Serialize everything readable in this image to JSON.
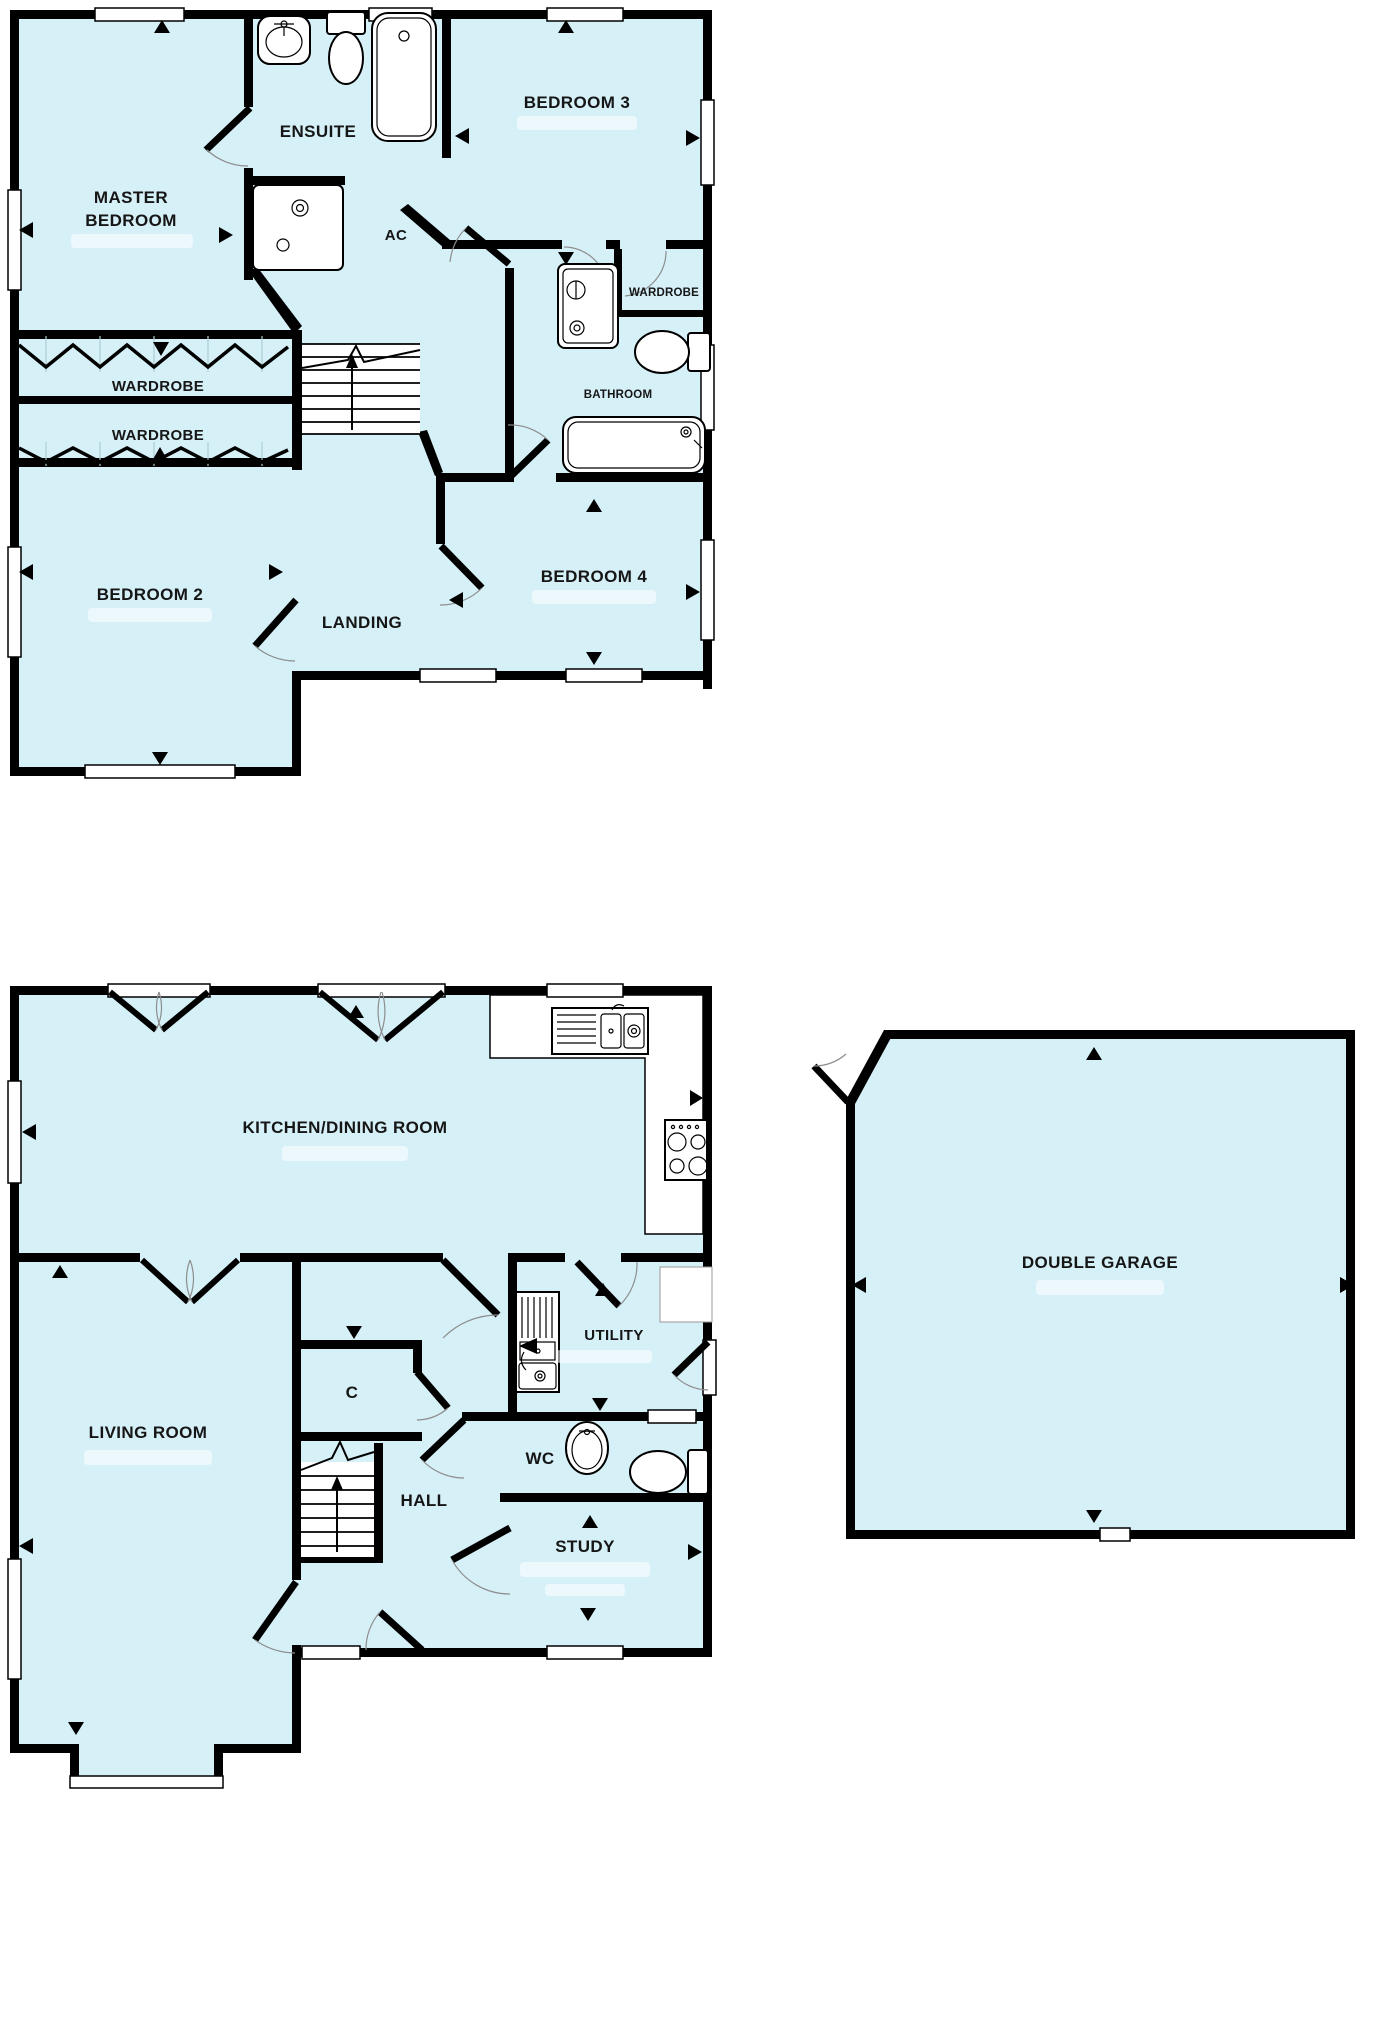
{
  "plan": {
    "colors": {
      "room_fill": "#d6f0f8",
      "wall": "#000000",
      "fixture_fill": "#ffffff",
      "label_color": "#161616"
    },
    "first_floor": {
      "rooms": {
        "master_bedroom": {
          "label_line1": "MASTER",
          "label_line2": "BEDROOM"
        },
        "ensuite": {
          "label": "ENSUITE"
        },
        "ac": {
          "label": "AC"
        },
        "bedroom3": {
          "label": "BEDROOM 3"
        },
        "wardrobe_top": {
          "label": "WARDROBE"
        },
        "wardrobe_bottom": {
          "label": "WARDROBE"
        },
        "wardrobe_small": {
          "label": "WARDROBE"
        },
        "bathroom": {
          "label": "BATHROOM"
        },
        "bedroom2": {
          "label": "BEDROOM 2"
        },
        "landing": {
          "label": "LANDING"
        },
        "bedroom4": {
          "label": "BEDROOM 4"
        }
      }
    },
    "ground_floor": {
      "rooms": {
        "kitchen_dining": {
          "label": "KITCHEN/DINING ROOM"
        },
        "living_room": {
          "label": "LIVING ROOM"
        },
        "cupboard": {
          "label": "C"
        },
        "utility": {
          "label": "UTILITY"
        },
        "wc": {
          "label": "WC"
        },
        "hall": {
          "label": "HALL"
        },
        "study": {
          "label": "STUDY"
        },
        "double_garage": {
          "label": "DOUBLE GARAGE"
        }
      }
    }
  }
}
